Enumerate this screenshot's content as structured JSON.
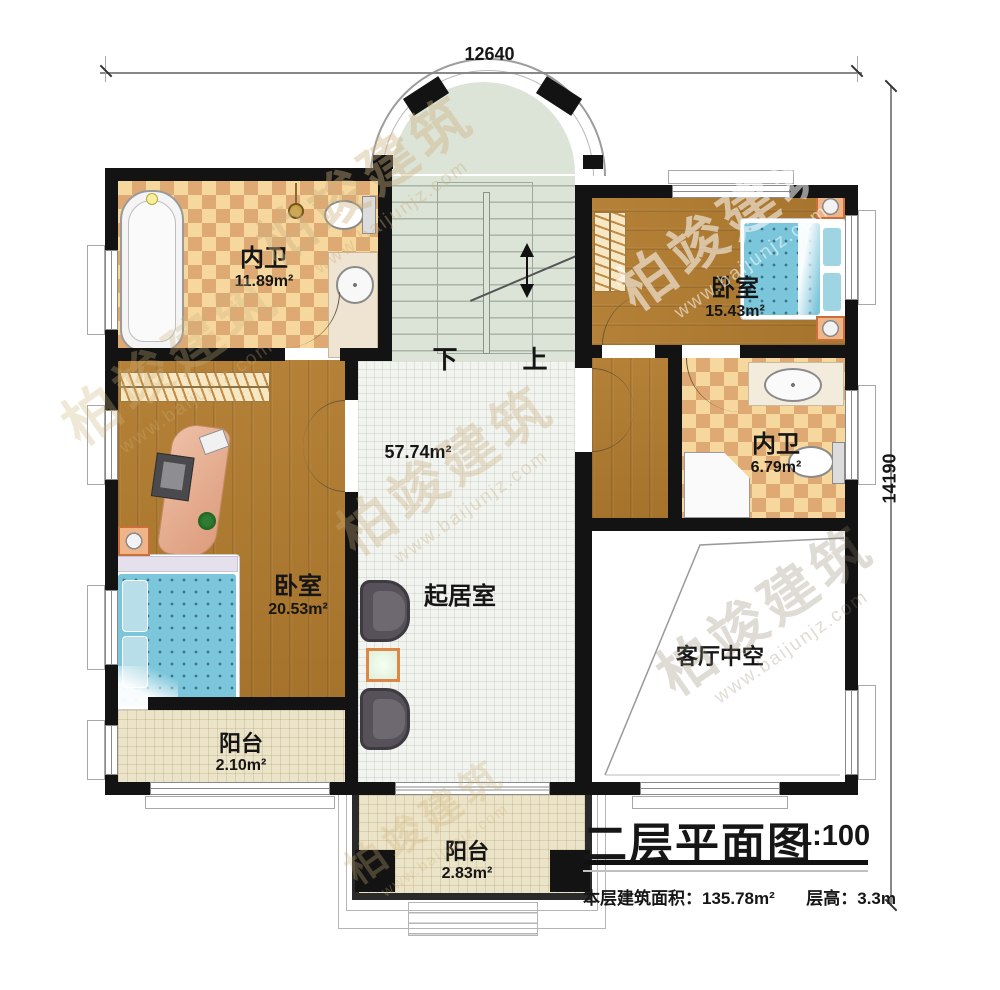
{
  "title_block": {
    "title": "二层平面图",
    "scale": "1:100",
    "area_label": "本层建筑面积：",
    "area_value": "135.78m²",
    "height_label": "层高：",
    "height_value": "3.3m"
  },
  "dimensions": {
    "width": "12640",
    "height": "14190"
  },
  "rooms": {
    "bath_top_left": {
      "label": "内卫",
      "area": "11.89m²"
    },
    "bedroom_top_right": {
      "label": "卧室",
      "area": "15.43m²"
    },
    "bath_right": {
      "label": "内卫",
      "area": "6.79m²"
    },
    "bedroom_left": {
      "label": "卧室",
      "area": "20.53m²"
    },
    "living_room": {
      "label": "起居室",
      "area": "57.74m²"
    },
    "void": {
      "label": "客厅中空"
    },
    "balcony_left": {
      "label": "阳台",
      "area": "2.10m²"
    },
    "balcony_bottom": {
      "label": "阳台",
      "area": "2.83m²"
    }
  },
  "stairs": {
    "down_label": "下",
    "up_label": "上"
  },
  "watermark": {
    "brand": "柏竣建筑",
    "site": "www.baijunjz.com"
  },
  "colors": {
    "wall": "#131313",
    "wood": "#b08036",
    "tile": "#e8b97e",
    "living_floor": "#f2f4f0",
    "stair_floor": "#dce3d7",
    "balcony_floor": "#ece4c9",
    "bed_blue": "#7cc6db",
    "accent_orange": "#dd8747"
  }
}
